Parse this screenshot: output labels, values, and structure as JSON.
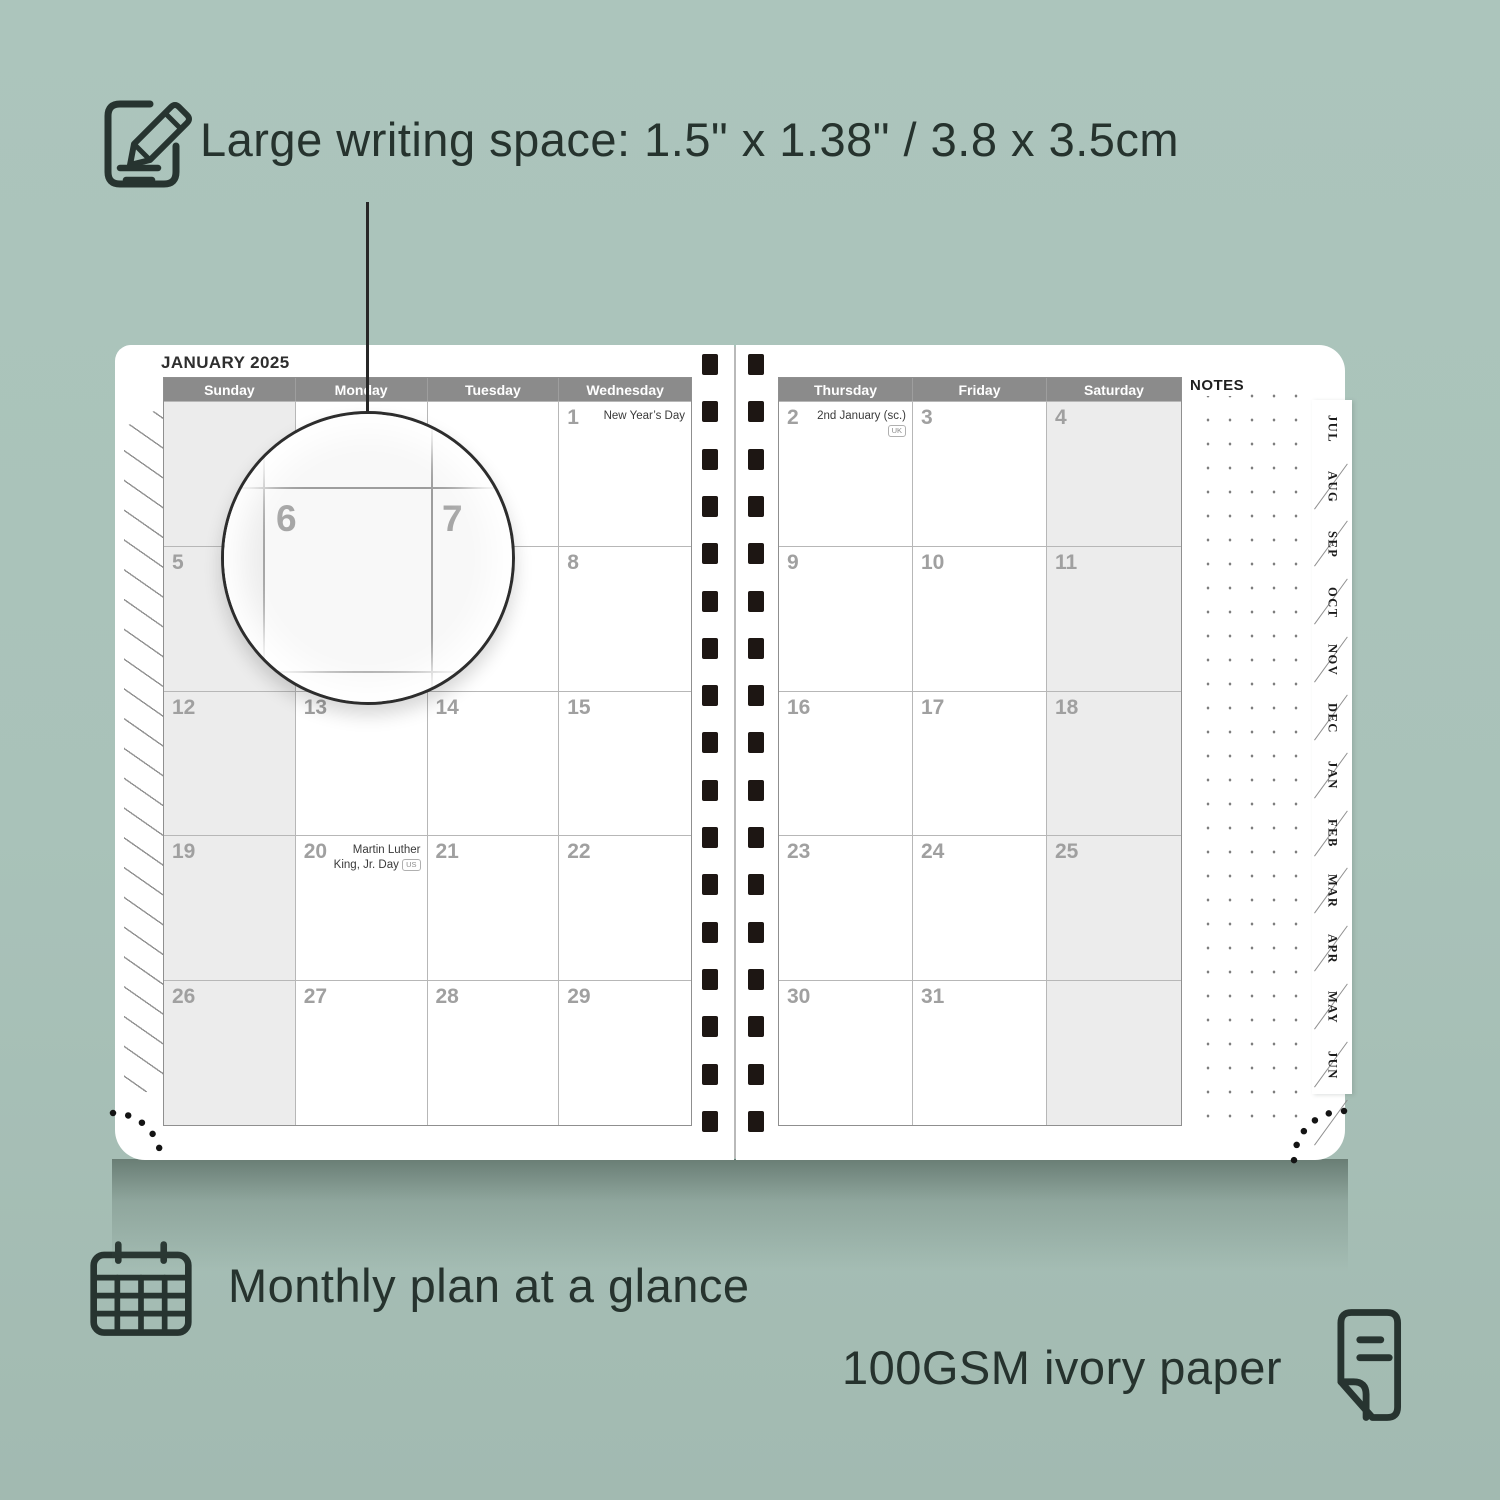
{
  "colors": {
    "background": "#a9c2b9",
    "ink": "#26332e",
    "page": "#ffffff",
    "header_bar": "#8b8b8b",
    "shaded_cell": "#ececec",
    "date_number": "#a0a0a0",
    "spiral": "#1d1613"
  },
  "captions": {
    "top": "Large writing space: 1.5\" x 1.38\" / 3.8 x 3.5cm",
    "bottom_left": "Monthly plan at a glance",
    "bottom_right": "100GSM ivory paper"
  },
  "icons": {
    "top": "notepad-pencil-icon",
    "bottom_left": "calendar-grid-icon",
    "bottom_right": "paper-sheet-icon"
  },
  "planner": {
    "month_title": "JANUARY 2025",
    "notes_label": "NOTES",
    "left_page_day_headers": [
      "Sunday",
      "Monday",
      "Tuesday",
      "Wednesday"
    ],
    "right_page_day_headers": [
      "Thursday",
      "Friday",
      "Saturday"
    ],
    "month_tabs": [
      "JUL",
      "AUG",
      "SEP",
      "OCT",
      "NOV",
      "DEC",
      "JAN",
      "FEB",
      "MAR",
      "APR",
      "MAY",
      "JUN"
    ],
    "left_page_weeks": [
      [
        {
          "date": ""
        },
        {
          "date": ""
        },
        {
          "date": ""
        },
        {
          "date": "1",
          "holiday": "New Year’s Day"
        }
      ],
      [
        {
          "date": "5"
        },
        {
          "date": "6"
        },
        {
          "date": "7"
        },
        {
          "date": "8"
        }
      ],
      [
        {
          "date": "12"
        },
        {
          "date": "13"
        },
        {
          "date": "14"
        },
        {
          "date": "15"
        }
      ],
      [
        {
          "date": "19"
        },
        {
          "date": "20",
          "holiday": "Martin Luther King, Jr. Day",
          "badge": "US"
        },
        {
          "date": "21"
        },
        {
          "date": "22"
        }
      ],
      [
        {
          "date": "26"
        },
        {
          "date": "27"
        },
        {
          "date": "28"
        },
        {
          "date": "29"
        }
      ]
    ],
    "right_page_weeks": [
      [
        {
          "date": "2",
          "holiday": "2nd January (sc.)",
          "badge": "UK"
        },
        {
          "date": "3"
        },
        {
          "date": "4"
        }
      ],
      [
        {
          "date": "9"
        },
        {
          "date": "10"
        },
        {
          "date": "11"
        }
      ],
      [
        {
          "date": "16"
        },
        {
          "date": "17"
        },
        {
          "date": "18"
        }
      ],
      [
        {
          "date": "23"
        },
        {
          "date": "24"
        },
        {
          "date": "25"
        }
      ],
      [
        {
          "date": "30"
        },
        {
          "date": "31"
        },
        {
          "date": ""
        }
      ]
    ],
    "magnifier_dates": [
      "6",
      "7"
    ]
  }
}
